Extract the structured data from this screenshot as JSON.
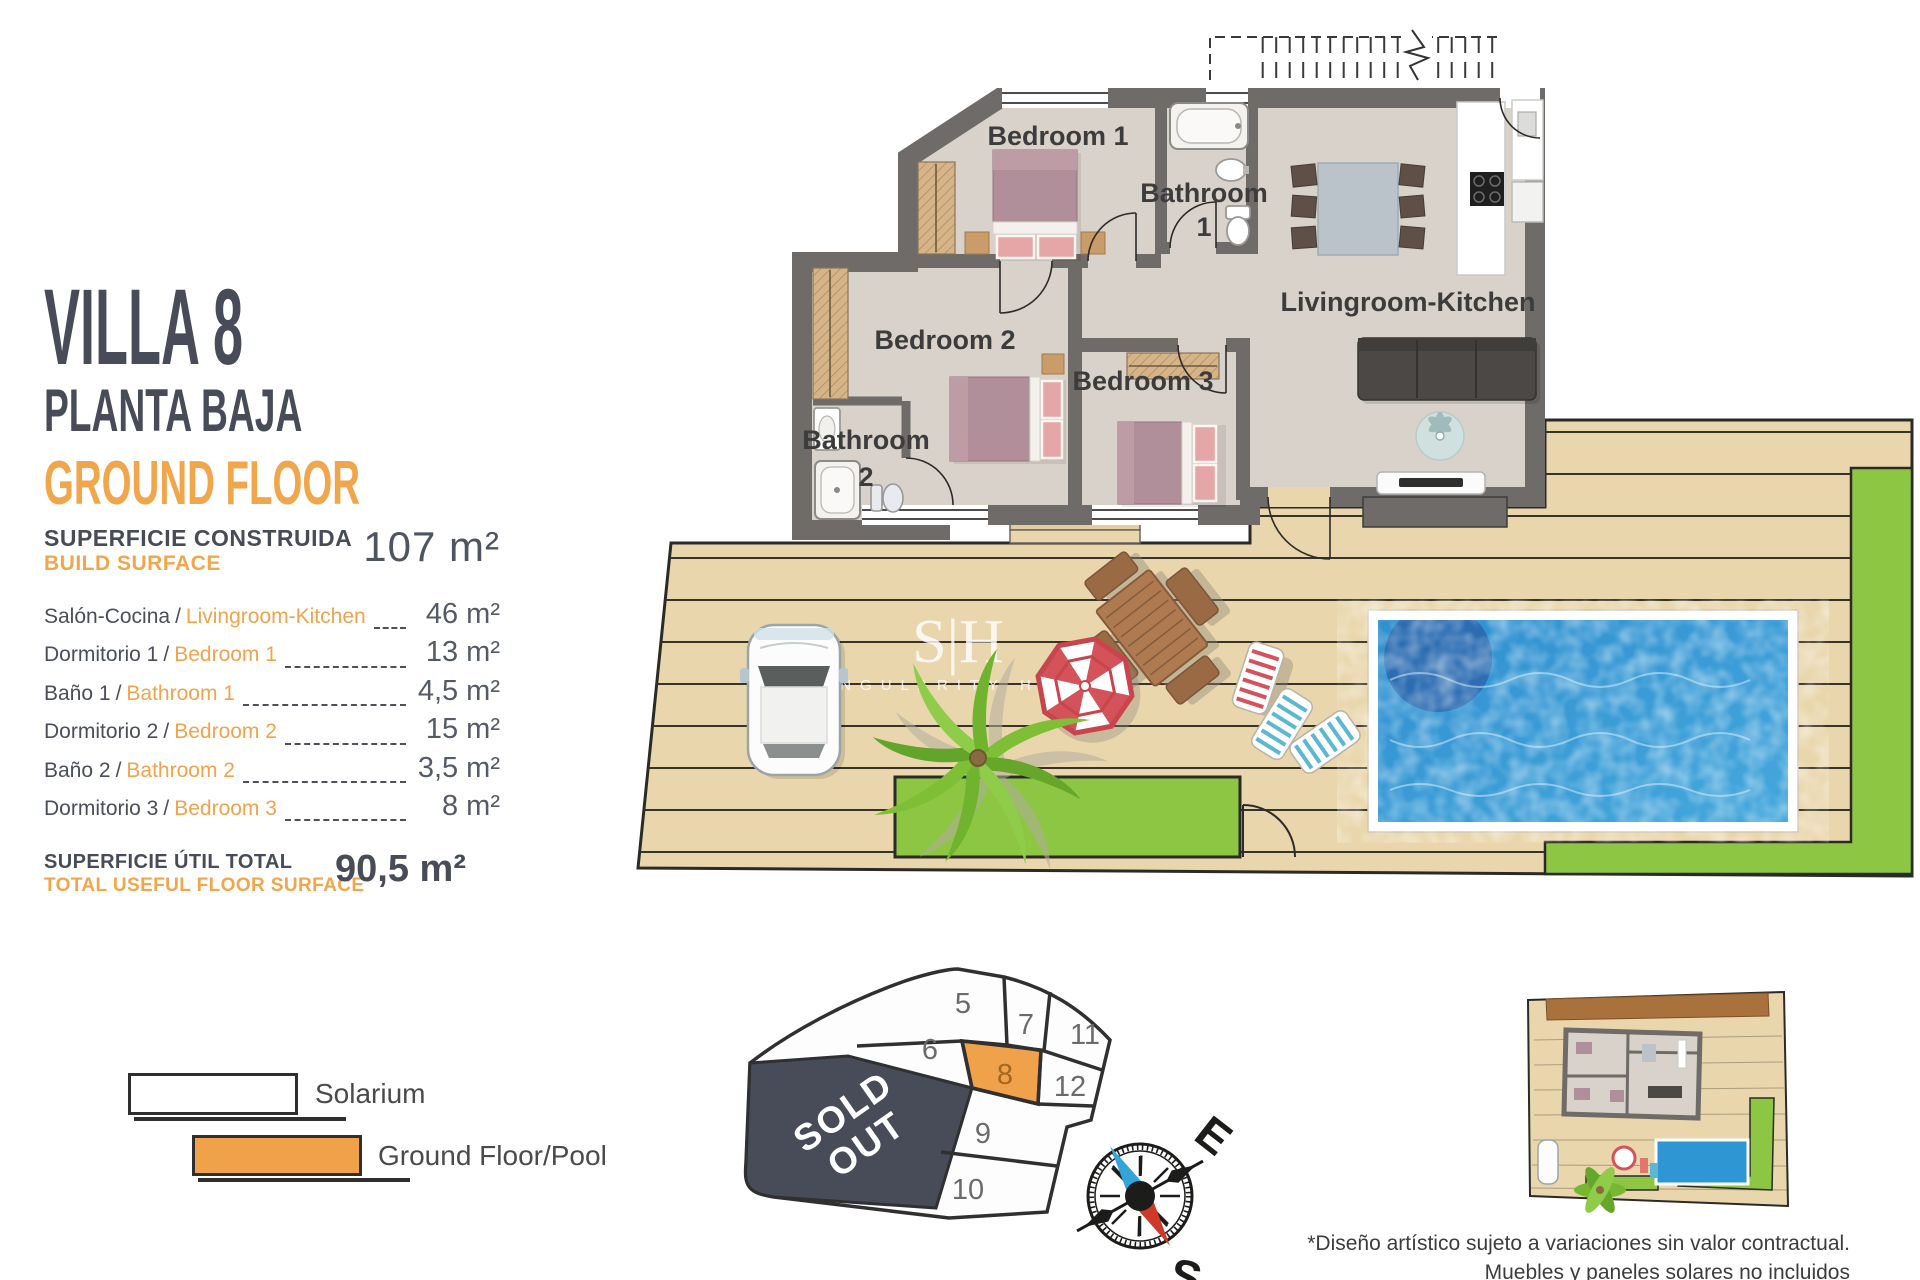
{
  "panel": {
    "title": "VILLA 8",
    "subtitle_es": "PLANTA BAJA",
    "subtitle_en": "GROUND FLOOR",
    "sep": "/",
    "build": {
      "es": "SUPERFICIE CONSTRUIDA",
      "en": "BUILD SURFACE",
      "value": "107 m²"
    },
    "rooms": [
      {
        "es": "Salón-Cocina",
        "en": "Livingroom-Kitchen",
        "value": "46 m²"
      },
      {
        "es": "Dormitorio 1",
        "en": "Bedroom 1",
        "value": "13 m²"
      },
      {
        "es": "Baño 1",
        "en": "Bathroom 1",
        "value": "4,5 m²"
      },
      {
        "es": "Dormitorio 2",
        "en": "Bedroom 2",
        "value": "15 m²"
      },
      {
        "es": "Baño 2",
        "en": "Bathroom 2",
        "value": "3,5 m²"
      },
      {
        "es": "Dormitorio 3",
        "en": "Bedroom 3",
        "value": "8 m²"
      }
    ],
    "total": {
      "es": "SUPERFICIE ÚTIL TOTAL",
      "en": "TOTAL USEFUL FLOOR SURFACE",
      "value": "90,5 m²"
    }
  },
  "floorplan": {
    "labels": {
      "bedroom1": "Bedroom 1",
      "bathroom1_l1": "Bathroom",
      "bathroom1_l2": "1",
      "bedroom2": "Bedroom 2",
      "bedroom3": "Bedroom 3",
      "bathroom2_l1": "Bathroom",
      "bathroom2_l2": "2",
      "living": "Livingroom-Kitchen"
    }
  },
  "watermark": {
    "initials": "S|H",
    "name": "SINGULARITY HOMES"
  },
  "legend": {
    "items": [
      {
        "label": "Solarium",
        "swatch": "#FFFFFF"
      },
      {
        "label": "Ground Floor/Pool",
        "swatch": "#F0A24A"
      }
    ]
  },
  "site_plan": {
    "sold_out_l1": "SOLD",
    "sold_out_l2": "OUT",
    "plots": {
      "p5": "5",
      "p6": "6",
      "p7": "7",
      "p8": "8",
      "p9": "9",
      "p10": "10",
      "p11": "11",
      "p12": "12"
    },
    "highlighted_plot": "8",
    "highlight_color": "#F0A24A"
  },
  "compass": {
    "east": "E",
    "south": "S"
  },
  "disclaimer": {
    "line1": "*Diseño artístico sujeto a variaciones sin valor contractual.",
    "line2": "Muebles y paneles solares no incluidos"
  },
  "colors": {
    "accent_orange": "#F2A64B",
    "heading": "#474C58",
    "wall": "#6F6B69",
    "floor": "#D9D2CA",
    "deck": "#E9D6AC",
    "lawn": "#8CC643",
    "pool": "#3399D4",
    "sold_out": "#474C58"
  }
}
